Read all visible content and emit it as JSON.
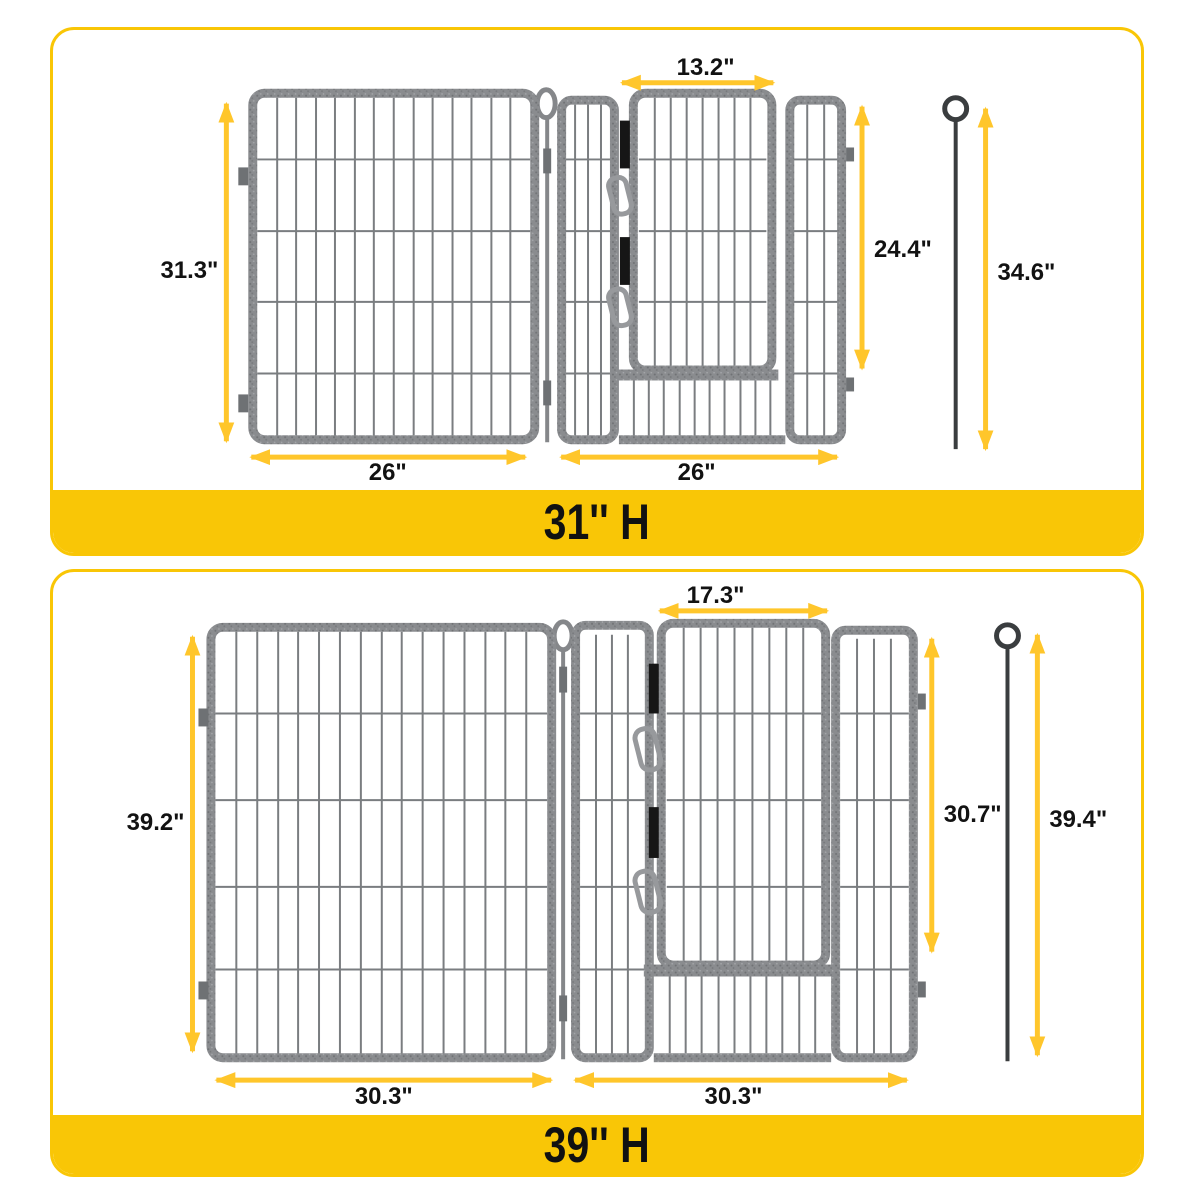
{
  "page": {
    "background": "#FFFFFF"
  },
  "colors": {
    "accent_yellow": "#F9C606",
    "arrow_yellow": "#FFC62B",
    "frame_gray": "#8A8C8F",
    "bar_gray": "#7A7D80",
    "stake_gray": "#3A3D3F",
    "label_black": "#121212"
  },
  "icons": {
    "hinge_loop": "hinge-loop-icon",
    "carabiner": "carabiner-clip-icon",
    "ground_stake": "ground-stake-icon"
  },
  "sections": [
    {
      "banner_label": "31'' H",
      "dimensions": {
        "panel_height": "31.3\"",
        "left_panel_width": "26\"",
        "right_panel_width": "26\"",
        "gate_width": "13.2\"",
        "gate_height": "24.4\"",
        "stake_length": "34.6\""
      }
    },
    {
      "banner_label": "39'' H",
      "dimensions": {
        "panel_height": "39.2\"",
        "left_panel_width": "30.3\"",
        "right_panel_width": "30.3\"",
        "gate_width": "17.3\"",
        "gate_height": "30.7\"",
        "stake_length": "39.4\""
      }
    }
  ]
}
